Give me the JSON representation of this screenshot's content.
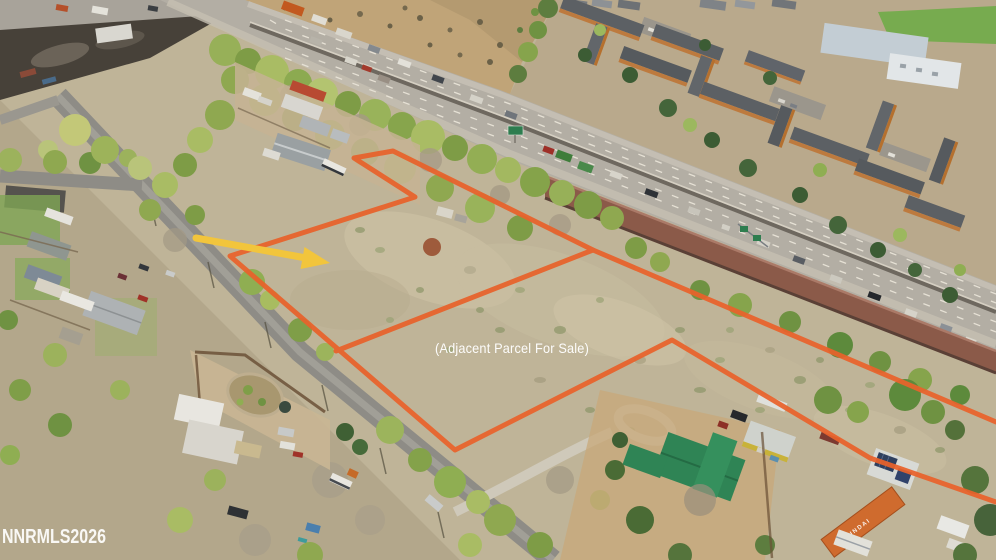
{
  "annotations": {
    "parcel_label": "(Adjacent Parcel For Sale)",
    "watermark": "NNRMLS2026",
    "outline_color": "#E8622B",
    "arrow_color": "#F2C53C",
    "label_color": "#FFFFFF"
  },
  "scene": {
    "container_label": "HYUNDAI"
  }
}
